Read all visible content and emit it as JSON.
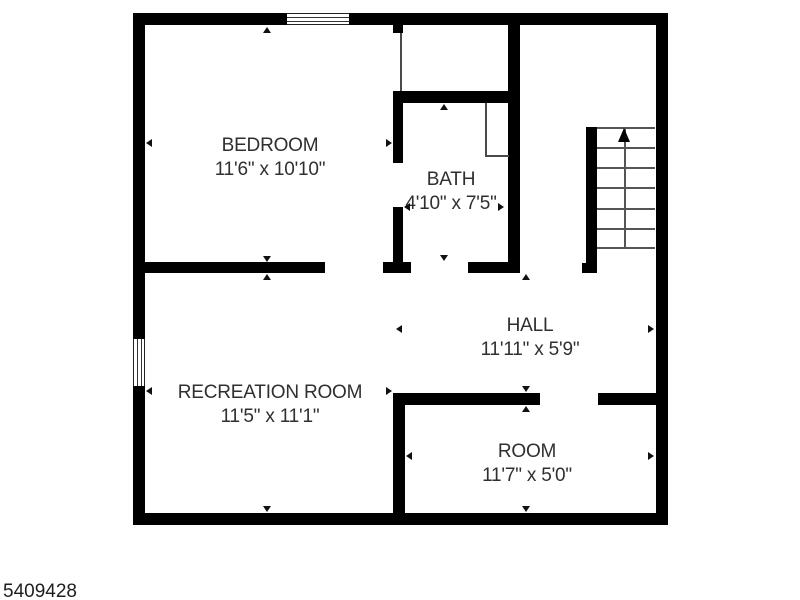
{
  "meta": {
    "listing_id": "5409428"
  },
  "plan": {
    "type": "floor-plan",
    "background_color": "#ffffff",
    "wall_color": "#000000",
    "fixture_line_color": "#555555",
    "text_color": "#2f2f2f",
    "rooms": [
      {
        "id": "bedroom",
        "name": "BEDROOM",
        "dimensions": "11'6\" x 10'10\""
      },
      {
        "id": "bath",
        "name": "BATH",
        "dimensions": "4'10\" x 7'5\""
      },
      {
        "id": "hall",
        "name": "HALL",
        "dimensions": "11'11\" x 5'9\""
      },
      {
        "id": "recreation-room",
        "name": "RECREATION ROOM",
        "dimensions": "11'5\" x 11'1\""
      },
      {
        "id": "room",
        "name": "ROOM",
        "dimensions": "11'7\" x 5'0\""
      }
    ],
    "features": {
      "stairs_direction": "up",
      "windows": 2,
      "door_openings": 5
    }
  }
}
